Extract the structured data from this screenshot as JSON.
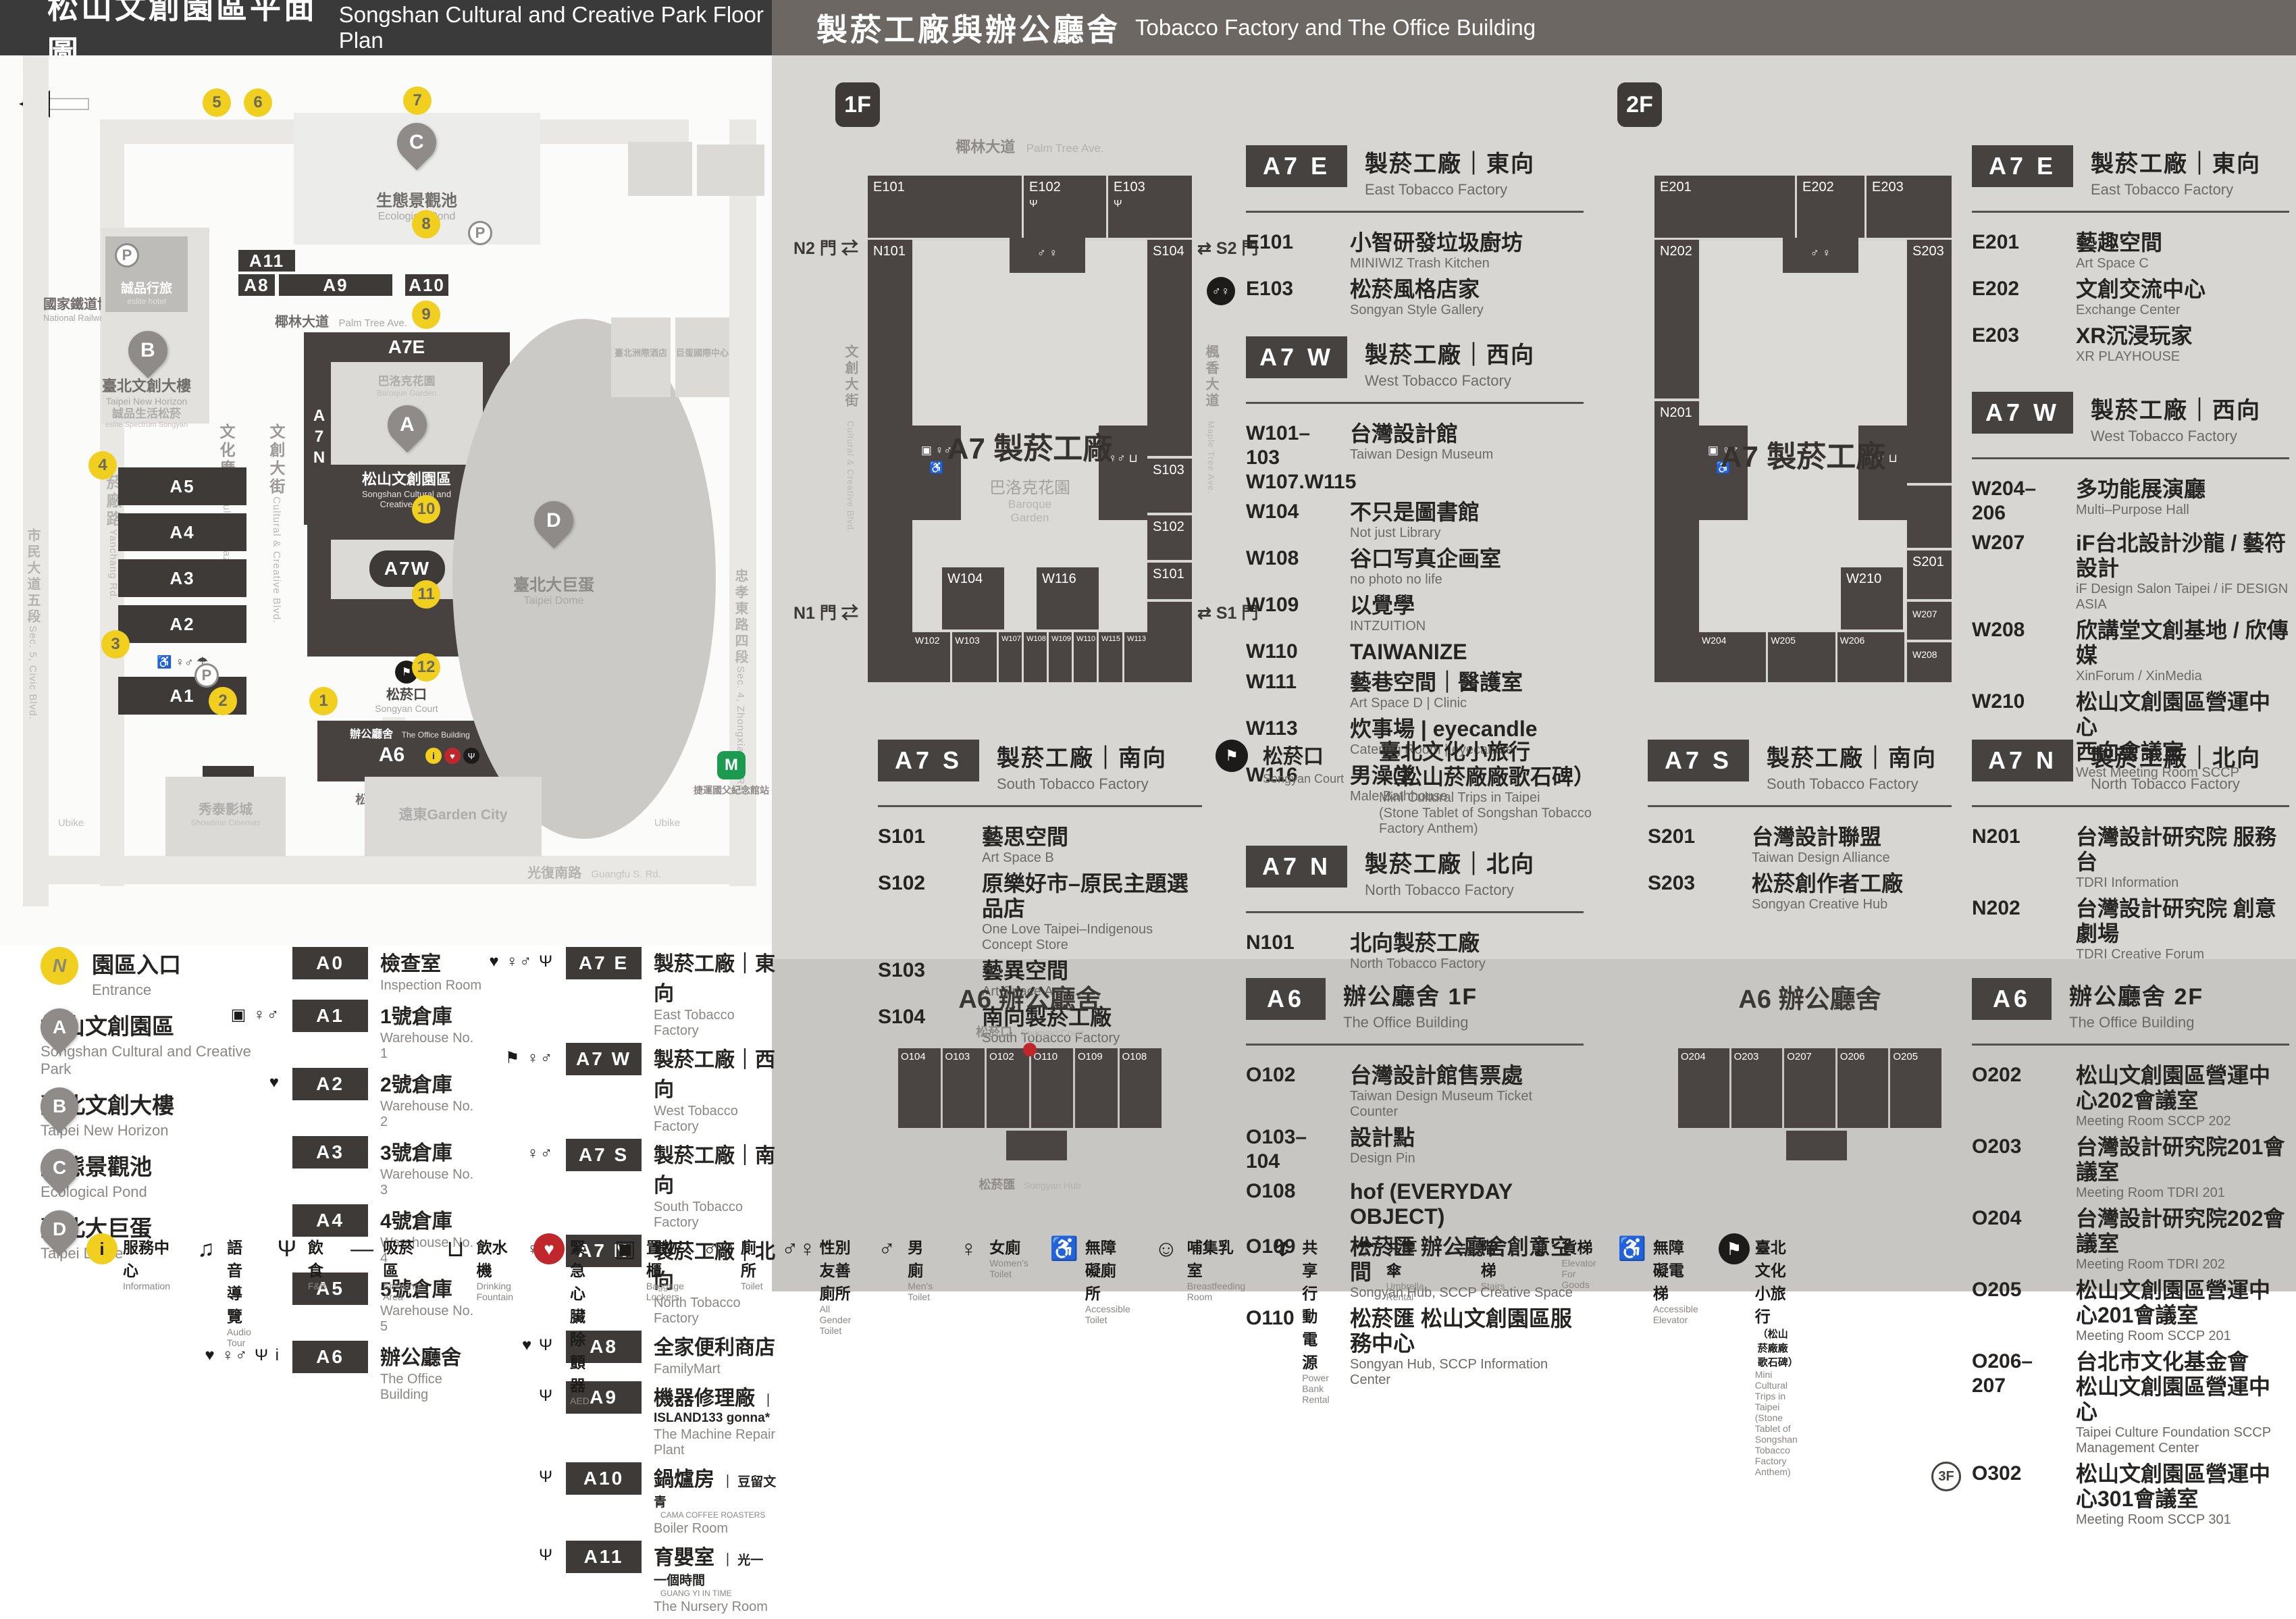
{
  "left": {
    "header": {
      "zh": "松山文創園區平面圖",
      "en": "Songshan Cultural and Creative Park Floor Plan"
    },
    "map": {
      "railway_zh": "國家鐵道博物館",
      "railway_en": "National Railway Museum",
      "pond_zh": "生態景觀池",
      "pond_en": "Ecological Pond",
      "hotel_zh": "誠品行旅",
      "hotel_en": "eslite hotel",
      "nh_zh": "臺北文創大樓",
      "nh_en": "Taipei New Horizon",
      "spectrum_zh": "誠品生活松菸",
      "spectrum_en": "eslite Spectrum Songyan",
      "park_zh": "松山文創園區",
      "park_en1": "Songshan Cultural and",
      "park_en2": "Creative Park",
      "a7e": "A7E",
      "a7n": "A7N",
      "a7s": "A7S",
      "a7w": "A7W",
      "a6": "A6",
      "baroque_zh": "巴洛克花園",
      "baroque_en": "Baroque Garden",
      "court_zh": "松菸口",
      "court_en": "Songyan Court",
      "office_zh": "辦公廳舍",
      "office_en": "The Office Building",
      "hub_zh": "松菸匯",
      "hub_en": "Songyan Hub",
      "dome_zh": "臺北大巨蛋",
      "dome_en": "Taipei Dome",
      "intercont_zh": "臺北洲際酒店",
      "domeintl_zh": "巨蛋國際中心",
      "showtime_zh": "秀泰影城",
      "showtime_en": "Showtime Cinemas",
      "garden_zh": "遠東Garden City",
      "mrt_zh": "捷運國父紀念館站",
      "ubike": "Ubike",
      "p": "P",
      "m": "M",
      "streets": {
        "palm_zh": "椰林大道",
        "palm_en": "Palm Tree Ave.",
        "plaza_zh": "文化廣場",
        "plaza_en": "Cultural Plaza",
        "cc_zh": "文創大街",
        "cc_en": "Cultural & Creative Blvd.",
        "maple_zh": "楓香大道",
        "maple_en": "Maple Tree Ave.",
        "songyanave_zh": "松菸大道",
        "songyanave_en": "Songyan Ave.",
        "yanchang_zh": "菸廠路",
        "yanchang_en": "Yanchang Rd.",
        "civic_zh": "市民大道五段",
        "civic_en": "Sec. 5, Civic Blvd.",
        "guangfu_zh": "光復南路",
        "guangfu_en": "Guangfu S. Rd.",
        "zhongxiao_zh": "忠孝東路四段",
        "zhongxiao_en": "Sec. 4, Zhongxiao E. Rd."
      },
      "badges": {
        "a11": "A11",
        "a8": "A8",
        "a9": "A9",
        "a10": "A10",
        "a5": "A5",
        "a4": "A4",
        "a3": "A3",
        "a2": "A2",
        "a1": "A1",
        "a0": "A0"
      },
      "pins": {
        "a": "A",
        "b": "B",
        "c": "C",
        "d": "D"
      },
      "numbers": [
        "1",
        "2",
        "3",
        "4",
        "5",
        "6",
        "7",
        "8",
        "9",
        "10",
        "11",
        "12"
      ],
      "stack_icons": "♿ ♀♂ ☂"
    },
    "legend_places": [
      {
        "marker": "N",
        "mcls": "lmark yellow",
        "zh": "園區入口",
        "en": "Entrance"
      },
      {
        "marker": "A",
        "mcls": "lmark pin",
        "zh": "松山文創園區",
        "en": "Songshan Cultural and Creative Park"
      },
      {
        "marker": "B",
        "mcls": "lmark pin",
        "zh": "臺北文創大樓",
        "en": "Taipei New Horizon"
      },
      {
        "marker": "C",
        "mcls": "lmark pin",
        "zh": "生態景觀池",
        "en": "Ecological Pond"
      },
      {
        "marker": "D",
        "mcls": "lmark pin",
        "zh": "臺北大巨蛋",
        "en": "Taipei Dome"
      }
    ],
    "legend_a": [
      {
        "icons": "",
        "badge": "A0",
        "zh": "檢查室",
        "en": "Inspection Room"
      },
      {
        "icons": "▣ ♀♂",
        "badge": "A1",
        "zh": "1號倉庫",
        "en": "Warehouse No. 1"
      },
      {
        "icons": "♥",
        "badge": "A2",
        "zh": "2號倉庫",
        "en": "Warehouse No. 2"
      },
      {
        "icons": "",
        "badge": "A3",
        "zh": "3號倉庫",
        "en": "Warehouse No. 3"
      },
      {
        "icons": "",
        "badge": "A4",
        "zh": "4號倉庫",
        "en": "Warehouse No. 4"
      },
      {
        "icons": "",
        "badge": "A5",
        "zh": "5號倉庫",
        "en": "Warehouse No. 5"
      },
      {
        "icons": "♥ ♀♂ Ψ i",
        "badge": "A6",
        "zh": "辦公廳舍",
        "en": "The Office Building"
      }
    ],
    "legend_b": [
      {
        "icons": "♥ ♀♂ Ψ",
        "badge": "A7 E",
        "zh": "製菸工廠｜東向",
        "en": "East Tobacco Factory"
      },
      {
        "icons": "⚑ ♀♂",
        "badge": "A7 W",
        "zh": "製菸工廠｜西向",
        "en": "West Tobacco Factory"
      },
      {
        "icons": "♀♂",
        "badge": "A7 S",
        "zh": "製菸工廠｜南向",
        "en": "South Tobacco Factory"
      },
      {
        "icons": "♀♂",
        "badge": "A7 N",
        "zh": "製菸工廠｜北向",
        "en": "North Tobacco Factory"
      },
      {
        "icons": "♥ Ψ",
        "badge": "A8",
        "zh": "全家便利商店",
        "en": "FamilyMart"
      },
      {
        "icons": "Ψ",
        "badge": "A9",
        "zh": "機器修理廠",
        "brand": "ISLAND133 gonna*",
        "en": "The Machine Repair Plant"
      },
      {
        "icons": "Ψ",
        "badge": "A10",
        "zh": "鍋爐房",
        "brand": "豆留文青",
        "brand_en": "CAMA COFFEE ROASTERS",
        "en": "Boiler Room"
      },
      {
        "icons": "Ψ",
        "badge": "A11",
        "zh": "育嬰室",
        "brand": "光一 一個時間",
        "brand_en": "GUANG YI IN TIME",
        "en": "The Nursery Room"
      }
    ],
    "strip": [
      {
        "icls": "sico yellow",
        "glyph": "i",
        "zh": "服務中心",
        "en": "Information"
      },
      {
        "icls": "sico plain",
        "glyph": "♫",
        "zh": "語音導覽",
        "en": "Audio Tour"
      },
      {
        "icls": "sico plain",
        "glyph": "Ψ",
        "zh": "飲食",
        "en": "F&B"
      },
      {
        "icls": "sico plain",
        "glyph": "—",
        "zh": "吸菸區",
        "en": "Smoking Area"
      },
      {
        "icls": "sico plain",
        "glyph": "⊔",
        "zh": "飲水機",
        "en": "Drinking Fountain"
      },
      {
        "icls": "sico red",
        "glyph": "♥",
        "zh": "緊急心臟除顫器",
        "en": "AED"
      },
      {
        "icls": "sico plain",
        "glyph": "▣",
        "zh": "置物櫃",
        "en": "Baggage Lockers"
      },
      {
        "icls": "sico plain",
        "glyph": "♂♀",
        "zh": "廁所",
        "en": "Toilet"
      },
      {
        "icls": "sico plain",
        "glyph": "♂♀",
        "zh": "性別友善廁所",
        "en": "All Gender Toilet"
      },
      {
        "icls": "sico plain",
        "glyph": "♂",
        "zh": "男廁",
        "en": "Men's Toilet"
      },
      {
        "icls": "sico plain",
        "glyph": "♀",
        "zh": "女廁",
        "en": "Women's Toilet"
      },
      {
        "icls": "sico plain",
        "glyph": "♿",
        "zh": "無障礙廁所",
        "en": "Accessible Toilet"
      },
      {
        "icls": "sico plain",
        "glyph": "☺",
        "zh": "哺集乳室",
        "en": "Breastfeeding Room"
      },
      {
        "icls": "sico plain",
        "glyph": "↯",
        "zh": "共享行動電源",
        "en": "Power Bank Rental"
      },
      {
        "icls": "sico plain",
        "glyph": "☂",
        "zh": "共享傘",
        "en": "Umbrella Rental"
      },
      {
        "icls": "sico plain",
        "glyph": "≡",
        "zh": "階梯",
        "en": "Stairs"
      },
      {
        "icls": "sico plain",
        "glyph": "⇕",
        "zh": "貨梯",
        "en": "Elevator For Goods"
      },
      {
        "icls": "sico plain",
        "glyph": "♿",
        "zh": "無障礙電梯",
        "en": "Accessible Elevator"
      },
      {
        "icls": "sico black",
        "glyph": "⚑",
        "zh": "臺北文化小旅行",
        "zh2": "（松山菸廠廠歌石碑）",
        "en": "Mini Cultural Trips in Taipei",
        "en2": "(Stone Tablet of Songshan Tobacco Factory Anthem)"
      }
    ]
  },
  "right": {
    "header": {
      "zh": "製菸工廠與辦公廳舍",
      "en": "Tobacco Factory and The Office Building"
    },
    "f1": {
      "floor": "1F",
      "plan": {
        "street_top_zh": "椰林大道",
        "street_top_en": "Palm Tree Ave.",
        "street_left_zh": "文創大街",
        "street_left_en": "Cultural & Creative Blvd.",
        "street_right_zh": "楓香大道",
        "street_right_en": "Maple Tree Ave.",
        "gate_n2": "N2 門 ⇄",
        "gate_s2": "⇄ S2 門",
        "gate_n1": "N1 門 ⇄",
        "gate_s1": "⇄ S1 門",
        "center": "A7 製菸工廠",
        "baroque_zh": "巴洛克花園",
        "baroque_en1": "Baroque",
        "baroque_en2": "Garden",
        "rooms": {
          "e": [
            "E101",
            "E102",
            "E103"
          ],
          "n": [
            "N101"
          ],
          "s": [
            "S104",
            "S103",
            "S102",
            "S101"
          ],
          "w_row": [
            "W102",
            "W103",
            "W107",
            "W108",
            "W109",
            "W110",
            "W115",
            "W113"
          ],
          "w_blocks": [
            "W104",
            "W116"
          ]
        },
        "amen_left": "▣ ♀♂ ♿",
        "amen_right": "♀♂ ⊔",
        "amen_top": "♂ ♀",
        "fork": "Ψ"
      },
      "a7e": {
        "badge": "A7 E",
        "zh": "製菸工廠｜東向",
        "en": "East Tobacco Factory",
        "items": [
          {
            "code": "E101",
            "zh": "小智研發垃圾廚坊",
            "en": "MINIWIZ Trash Kitchen"
          },
          {
            "icon": "♂♀",
            "code": "E103",
            "zh": "松菸風格店家",
            "en": "Songyan Style Gallery"
          }
        ]
      },
      "a7w": {
        "badge": "A7 W",
        "zh": "製菸工廠｜西向",
        "en": "West Tobacco Factory",
        "items": [
          {
            "code": "W101–103",
            "code2": "W107.W115",
            "zh": "台灣設計館",
            "en": "Taiwan Design Museum"
          },
          {
            "code": "W104",
            "zh": "不只是圖書館",
            "en": "Not just Library"
          },
          {
            "code": "W108",
            "zh": "谷口写真企画室",
            "en": "no photo no life"
          },
          {
            "code": "W109",
            "zh": "以覺學",
            "en": "INTZUITION"
          },
          {
            "code": "W110",
            "zh": "TAIWANIZE"
          },
          {
            "code": "W111",
            "zh": "藝巷空間｜醫護室",
            "en": "Art Space D | Clinic"
          },
          {
            "code": "W113",
            "zh": "炊事場 | eyecandle",
            "en": "Catering Room | eyecandle"
          },
          {
            "code": "W116",
            "zh": "男澡堂",
            "en": "Male Bathhouse"
          }
        ]
      },
      "court": {
        "icon": "⚑",
        "zh": "松菸口",
        "en": "Songyan Court",
        "t_zh1": "臺北文化小旅行",
        "t_zh2": "（松山菸廠廠歌石碑）",
        "t_en1": "Mini Cultural Trips in Taipei",
        "t_en2": "(Stone Tablet of Songshan Tobacco Factory Anthem)"
      },
      "a7s": {
        "badge": "A7 S",
        "zh": "製菸工廠｜南向",
        "en": "South Tobacco Factory",
        "items": [
          {
            "code": "S101",
            "zh": "藝思空間",
            "en": "Art Space B"
          },
          {
            "code": "S102",
            "zh": "原樂好市–原民主題選品店",
            "en": "One Love Taipei–Indigenous Concept Store"
          },
          {
            "code": "S103",
            "zh": "藝異空間",
            "en": "Art Space A"
          },
          {
            "code": "S104",
            "zh": "南向製菸工廠",
            "en": "South Tobacco Factory"
          }
        ]
      },
      "a7n": {
        "badge": "A7 N",
        "zh": "製菸工廠｜北向",
        "en": "North Tobacco Factory",
        "items": [
          {
            "code": "N101",
            "zh": "北向製菸工廠",
            "en": "North Tobacco Factory"
          }
        ]
      },
      "a6plan": {
        "title": "A6 辦公廳舍",
        "court_zh": "松菸口",
        "court_en": "Songyan Court",
        "hub_zh": "松菸匯",
        "hub_en": "Songyan Hub",
        "rooms": [
          "O104",
          "O103",
          "O102",
          "O110",
          "O109",
          "O108"
        ]
      },
      "a6": {
        "badge": "A6",
        "zh": "辦公廳舍 1F",
        "en": "The Office Building",
        "items": [
          {
            "code": "O102",
            "zh": "台灣設計館售票處",
            "en": "Taiwan Design Museum Ticket Counter"
          },
          {
            "code": "O103–104",
            "zh": "設計點",
            "en": "Design Pin"
          },
          {
            "code": "O108",
            "zh": "hof (EVERYDAY OBJECT)"
          },
          {
            "code": "O109",
            "zh": "松菸匯 辦公廳舍創意空間",
            "en": "Songyan Hub, SCCP Creative Space"
          },
          {
            "code": "O110",
            "zh": "松菸匯 松山文創園區服務中心",
            "en": "Songyan Hub, SCCP Information Center"
          }
        ]
      }
    },
    "f2": {
      "floor": "2F",
      "plan": {
        "center": "A7 製菸工廠",
        "rooms": {
          "e": [
            "E201",
            "E202",
            "E203"
          ],
          "n": [
            "N202",
            "N201"
          ],
          "s": [
            "S203",
            "S201"
          ],
          "w_row": [
            "W204",
            "W205",
            "W206"
          ],
          "w_col": [
            "W207",
            "W208"
          ],
          "w_block": "W210"
        },
        "amen_left": "▣ ♀♂ ♿",
        "amen_right": "♀♂ ⊔",
        "amen_top": "♂ ♀"
      },
      "a7e": {
        "badge": "A7 E",
        "zh": "製菸工廠｜東向",
        "en": "East Tobacco Factory",
        "items": [
          {
            "code": "E201",
            "zh": "藝趣空間",
            "en": "Art Space C"
          },
          {
            "code": "E202",
            "zh": "文創交流中心",
            "en": "Exchange Center"
          },
          {
            "code": "E203",
            "zh": "XR沉浸玩家",
            "en": "XR PLAYHOUSE"
          }
        ]
      },
      "a7w": {
        "badge": "A7 W",
        "zh": "製菸工廠｜西向",
        "en": "West Tobacco Factory",
        "items": [
          {
            "code": "W204–206",
            "zh": "多功能展演廳",
            "en": "Multi–Purpose Hall"
          },
          {
            "code": "W207",
            "zh": "iF台北設計沙龍 / 藝符設計",
            "en": "iF Design Salon Taipei / iF DESIGN ASIA"
          },
          {
            "code": "W208",
            "zh": "欣講堂文創基地 / 欣傳媒",
            "en": "XinForum / XinMedia"
          },
          {
            "code": "W210",
            "zh": "松山文創園區營運中心",
            "zh2": "西向會議室",
            "en": "West Meeting Room SCCP"
          }
        ]
      },
      "a7s": {
        "badge": "A7 S",
        "zh": "製菸工廠｜南向",
        "en": "South Tobacco Factory",
        "items": [
          {
            "code": "S201",
            "zh": "台灣設計聯盟",
            "en": "Taiwan Design Alliance"
          },
          {
            "code": "S203",
            "zh": "松菸創作者工廠",
            "en": "Songyan Creative Hub"
          }
        ]
      },
      "a7n": {
        "badge": "A7 N",
        "zh": "製菸工廠｜北向",
        "en": "North Tobacco Factory",
        "items": [
          {
            "code": "N201",
            "zh": "台灣設計研究院 服務台",
            "en": "TDRI Information"
          },
          {
            "code": "N202",
            "zh": "台灣設計研究院 創意劇場",
            "en": "TDRI Creative Forum"
          }
        ]
      },
      "a6plan": {
        "title": "A6 辦公廳舍",
        "rooms": [
          "O204",
          "O203",
          "O207",
          "O206",
          "O205"
        ]
      },
      "a6": {
        "badge": "A6",
        "zh": "辦公廳舍 2F",
        "en": "The Office Building",
        "items": [
          {
            "code": "O202",
            "zh": "松山文創園區營運中心202會議室",
            "en": "Meeting Room SCCP 202"
          },
          {
            "code": "O203",
            "zh": "台灣設計研究院201會議室",
            "en": "Meeting Room TDRI 201"
          },
          {
            "code": "O204",
            "zh": "台灣設計研究院202會議室",
            "en": "Meeting Room TDRI 202"
          },
          {
            "code": "O205",
            "zh": "松山文創園區營運中心201會議室",
            "en": "Meeting Room SCCP 201"
          },
          {
            "code": "O206–207",
            "zh": "台北市文化基金會",
            "zh2": "松山文創園區營運中心",
            "en": "Taipei Culture Foundation SCCP Management Center"
          },
          {
            "prefix": "3F",
            "code": "O302",
            "zh": "松山文創園區營運中心301會議室",
            "en": "Meeting Room SCCP 301"
          }
        ]
      }
    }
  }
}
